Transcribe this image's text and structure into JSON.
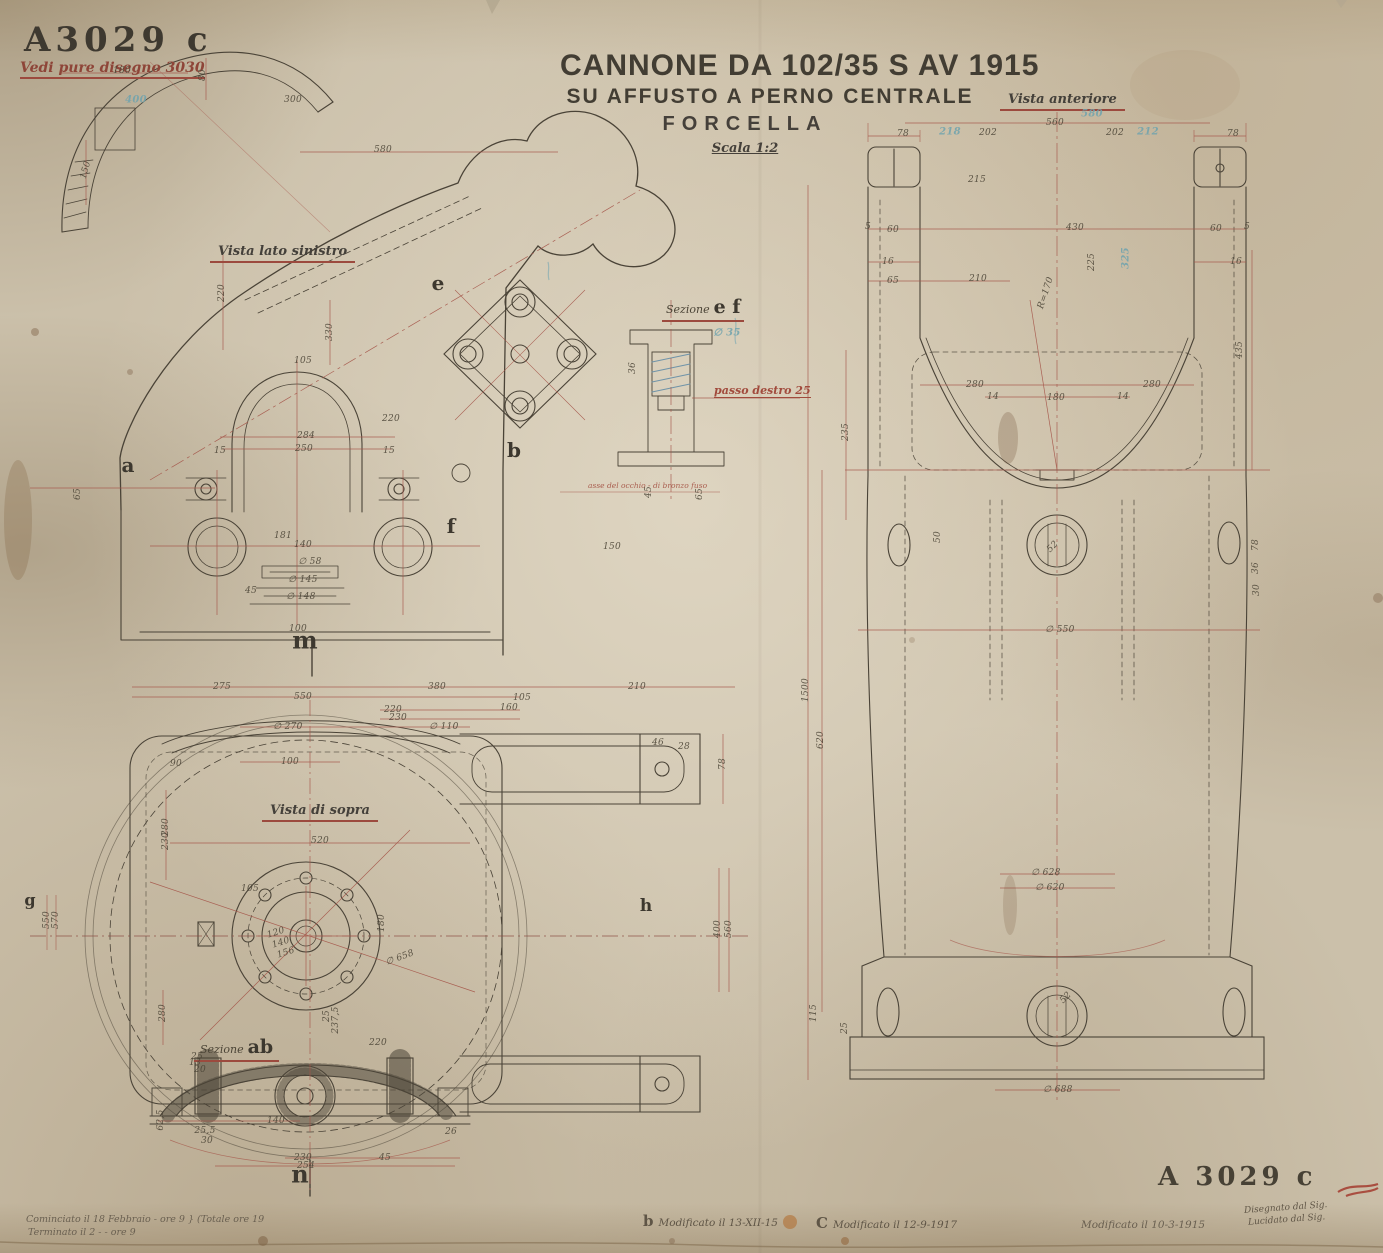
{
  "doc": {
    "number": "A3029 c",
    "note": "Vedi pure disegno 3030",
    "title_line1": "CANNONE DA 102/35 S AV 1915",
    "title_line2": "SU AFFUSTO A PERNO CENTRALE",
    "title_line3": "FORCELLA",
    "scale": "Scala 1:2",
    "number_bottom": "A 3029 c"
  },
  "views": {
    "front": "Vista anteriore",
    "left": "Vista lato sinistro",
    "top": "Vista di sopra",
    "section_ef_prefix": "Sezione",
    "section_ef_letters": "e f",
    "section_ab_prefix": "Sezione",
    "section_ab_letters": "ab"
  },
  "notes": {
    "thread": "passo destro 25",
    "axis": "asse del occhio - di bronzo fuso",
    "started": "Cominciato il 18 Febbraio - ore 9 } (Totale ore 19",
    "finished": "Terminato il 2  -  -  ore 9",
    "mod_b_letter": "b",
    "mod_b": "Modificato il 13-XII-15",
    "mod_c_letter": "C",
    "mod_c": "Modificato il 12-9-1917",
    "mod_2": "Modificato il 10-3-1915",
    "drawn_by": "Disegnato dal Sig.",
    "traced_by": "Lucidato dal Sig."
  },
  "markers": [
    {
      "t": "a",
      "x": 128,
      "y": 465,
      "s": 20
    },
    {
      "t": "b",
      "x": 514,
      "y": 450,
      "s": 20
    },
    {
      "t": "e",
      "x": 438,
      "y": 283,
      "s": 20
    },
    {
      "t": "f",
      "x": 451,
      "y": 526,
      "s": 20
    },
    {
      "t": "m",
      "x": 305,
      "y": 640,
      "s": 24
    },
    {
      "t": "n",
      "x": 300,
      "y": 1174,
      "s": 24
    },
    {
      "t": "g",
      "x": 30,
      "y": 900,
      "s": 16
    },
    {
      "t": "h",
      "x": 646,
      "y": 906,
      "s": 17
    }
  ],
  "dims": [
    {
      "t": "180",
      "x": 122,
      "y": 71
    },
    {
      "t": "80",
      "x": 203,
      "y": 75,
      "r": -90
    },
    {
      "t": "300",
      "x": 293,
      "y": 100
    },
    {
      "t": "400",
      "x": 136,
      "y": 100,
      "c": "b"
    },
    {
      "t": "150",
      "x": 86,
      "y": 170,
      "r": -75
    },
    {
      "t": "580",
      "x": 383,
      "y": 150
    },
    {
      "t": "220",
      "x": 222,
      "y": 293,
      "r": -90
    },
    {
      "t": "330",
      "x": 330,
      "y": 332,
      "r": -90
    },
    {
      "t": "105",
      "x": 303,
      "y": 361
    },
    {
      "t": "220",
      "x": 391,
      "y": 419
    },
    {
      "t": "284",
      "x": 306,
      "y": 436
    },
    {
      "t": "250",
      "x": 304,
      "y": 449
    },
    {
      "t": "15",
      "x": 220,
      "y": 451
    },
    {
      "t": "15",
      "x": 389,
      "y": 451
    },
    {
      "t": "65",
      "x": 78,
      "y": 494,
      "r": -90
    },
    {
      "t": "181",
      "x": 283,
      "y": 536
    },
    {
      "t": "140",
      "x": 303,
      "y": 545
    },
    {
      "t": "∅ 58",
      "x": 310,
      "y": 562
    },
    {
      "t": "∅ 145",
      "x": 303,
      "y": 580
    },
    {
      "t": "45",
      "x": 251,
      "y": 591
    },
    {
      "t": "∅ 148",
      "x": 301,
      "y": 597
    },
    {
      "t": "100",
      "x": 298,
      "y": 629
    },
    {
      "t": "36",
      "x": 633,
      "y": 368,
      "r": -90
    },
    {
      "t": "45",
      "x": 649,
      "y": 492,
      "r": -90
    },
    {
      "t": "65",
      "x": 700,
      "y": 494,
      "r": -90
    },
    {
      "t": "150",
      "x": 612,
      "y": 547
    },
    {
      "t": "∅ 35",
      "x": 727,
      "y": 333,
      "c": "b"
    },
    {
      "t": "560",
      "x": 1055,
      "y": 123
    },
    {
      "t": "78",
      "x": 903,
      "y": 134
    },
    {
      "t": "202",
      "x": 988,
      "y": 133
    },
    {
      "t": "218",
      "x": 950,
      "y": 132,
      "c": "b"
    },
    {
      "t": "202",
      "x": 1115,
      "y": 133
    },
    {
      "t": "212",
      "x": 1148,
      "y": 132,
      "c": "b"
    },
    {
      "t": "78",
      "x": 1233,
      "y": 134
    },
    {
      "t": "580",
      "x": 1092,
      "y": 114,
      "c": "b"
    },
    {
      "t": "215",
      "x": 977,
      "y": 180
    },
    {
      "t": "5",
      "x": 868,
      "y": 227
    },
    {
      "t": "60",
      "x": 893,
      "y": 230
    },
    {
      "t": "430",
      "x": 1075,
      "y": 228
    },
    {
      "t": "60",
      "x": 1216,
      "y": 229
    },
    {
      "t": "5",
      "x": 1247,
      "y": 227
    },
    {
      "t": "225",
      "x": 1092,
      "y": 262,
      "r": -90
    },
    {
      "t": "325",
      "x": 1126,
      "y": 258,
      "r": -90,
      "c": "b"
    },
    {
      "t": "16",
      "x": 888,
      "y": 262
    },
    {
      "t": "16",
      "x": 1236,
      "y": 262
    },
    {
      "t": "65",
      "x": 893,
      "y": 281
    },
    {
      "t": "210",
      "x": 978,
      "y": 279
    },
    {
      "t": "R=170",
      "x": 1046,
      "y": 293,
      "r": -72
    },
    {
      "t": "435",
      "x": 1240,
      "y": 350,
      "r": -90
    },
    {
      "t": "235",
      "x": 846,
      "y": 432,
      "r": -90
    },
    {
      "t": "280",
      "x": 975,
      "y": 385
    },
    {
      "t": "280",
      "x": 1152,
      "y": 385
    },
    {
      "t": "180",
      "x": 1056,
      "y": 398
    },
    {
      "t": "14",
      "x": 993,
      "y": 397
    },
    {
      "t": "14",
      "x": 1123,
      "y": 397
    },
    {
      "t": "50",
      "x": 938,
      "y": 537,
      "r": -90
    },
    {
      "t": "52",
      "x": 1053,
      "y": 547,
      "r": -45
    },
    {
      "t": "78",
      "x": 1256,
      "y": 545,
      "r": -90
    },
    {
      "t": "36",
      "x": 1256,
      "y": 568,
      "r": -90
    },
    {
      "t": "30",
      "x": 1257,
      "y": 590,
      "r": -90
    },
    {
      "t": "∅ 550",
      "x": 1060,
      "y": 630
    },
    {
      "t": "1500",
      "x": 806,
      "y": 690,
      "r": -90
    },
    {
      "t": "620",
      "x": 821,
      "y": 740,
      "r": -90
    },
    {
      "t": "∅ 628",
      "x": 1046,
      "y": 873
    },
    {
      "t": "∅ 620",
      "x": 1050,
      "y": 888
    },
    {
      "t": "115",
      "x": 814,
      "y": 1013,
      "r": -90
    },
    {
      "t": "25",
      "x": 845,
      "y": 1028,
      "r": -90
    },
    {
      "t": "52",
      "x": 1066,
      "y": 998,
      "r": -45
    },
    {
      "t": "∅ 688",
      "x": 1058,
      "y": 1090
    },
    {
      "t": "275",
      "x": 222,
      "y": 687
    },
    {
      "t": "380",
      "x": 437,
      "y": 687
    },
    {
      "t": "210",
      "x": 637,
      "y": 687
    },
    {
      "t": "550",
      "x": 303,
      "y": 697
    },
    {
      "t": "105",
      "x": 522,
      "y": 698
    },
    {
      "t": "220",
      "x": 393,
      "y": 710
    },
    {
      "t": "160",
      "x": 509,
      "y": 708
    },
    {
      "t": "230",
      "x": 398,
      "y": 718
    },
    {
      "t": "∅ 270",
      "x": 288,
      "y": 727
    },
    {
      "t": "∅ 110",
      "x": 444,
      "y": 727
    },
    {
      "t": "100",
      "x": 290,
      "y": 762
    },
    {
      "t": "90",
      "x": 176,
      "y": 764
    },
    {
      "t": "46",
      "x": 658,
      "y": 743
    },
    {
      "t": "28",
      "x": 684,
      "y": 747
    },
    {
      "t": "78",
      "x": 723,
      "y": 764,
      "r": -90
    },
    {
      "t": "280",
      "x": 166,
      "y": 827,
      "r": -90
    },
    {
      "t": "230",
      "x": 166,
      "y": 841,
      "r": -90
    },
    {
      "t": "520",
      "x": 320,
      "y": 841
    },
    {
      "t": "105",
      "x": 250,
      "y": 889
    },
    {
      "t": "120",
      "x": 276,
      "y": 933,
      "r": -18
    },
    {
      "t": "140",
      "x": 281,
      "y": 943,
      "r": -18
    },
    {
      "t": "156",
      "x": 286,
      "y": 953,
      "r": -18
    },
    {
      "t": "180",
      "x": 382,
      "y": 923,
      "r": -90
    },
    {
      "t": "∅ 658",
      "x": 400,
      "y": 958,
      "r": -20
    },
    {
      "t": "550",
      "x": 47,
      "y": 920,
      "r": -90
    },
    {
      "t": "570",
      "x": 56,
      "y": 920,
      "r": -90
    },
    {
      "t": "560",
      "x": 729,
      "y": 929,
      "r": -90
    },
    {
      "t": "400",
      "x": 718,
      "y": 929,
      "r": -90
    },
    {
      "t": "280",
      "x": 163,
      "y": 1013,
      "r": -90
    },
    {
      "t": "237,5",
      "x": 336,
      "y": 1020,
      "r": -90
    },
    {
      "t": "25",
      "x": 327,
      "y": 1016,
      "r": -90
    },
    {
      "t": "220",
      "x": 378,
      "y": 1043
    },
    {
      "t": "25",
      "x": 197,
      "y": 1057
    },
    {
      "t": "13",
      "x": 195,
      "y": 1063
    },
    {
      "t": "20",
      "x": 200,
      "y": 1070
    },
    {
      "t": "62,5",
      "x": 161,
      "y": 1120,
      "r": -90
    },
    {
      "t": "25,5",
      "x": 205,
      "y": 1131
    },
    {
      "t": "30",
      "x": 207,
      "y": 1141
    },
    {
      "t": "140",
      "x": 276,
      "y": 1121
    },
    {
      "t": "26",
      "x": 451,
      "y": 1132
    },
    {
      "t": "230",
      "x": 303,
      "y": 1158
    },
    {
      "t": "254",
      "x": 306,
      "y": 1166
    },
    {
      "t": "45",
      "x": 385,
      "y": 1158
    }
  ],
  "colors": {
    "paper": "#cbc0aa",
    "ink": "#4a4337",
    "dimension_red": "#a5564a",
    "pencil_blue": "#6fa3ae",
    "stamp": "#3e3930"
  }
}
